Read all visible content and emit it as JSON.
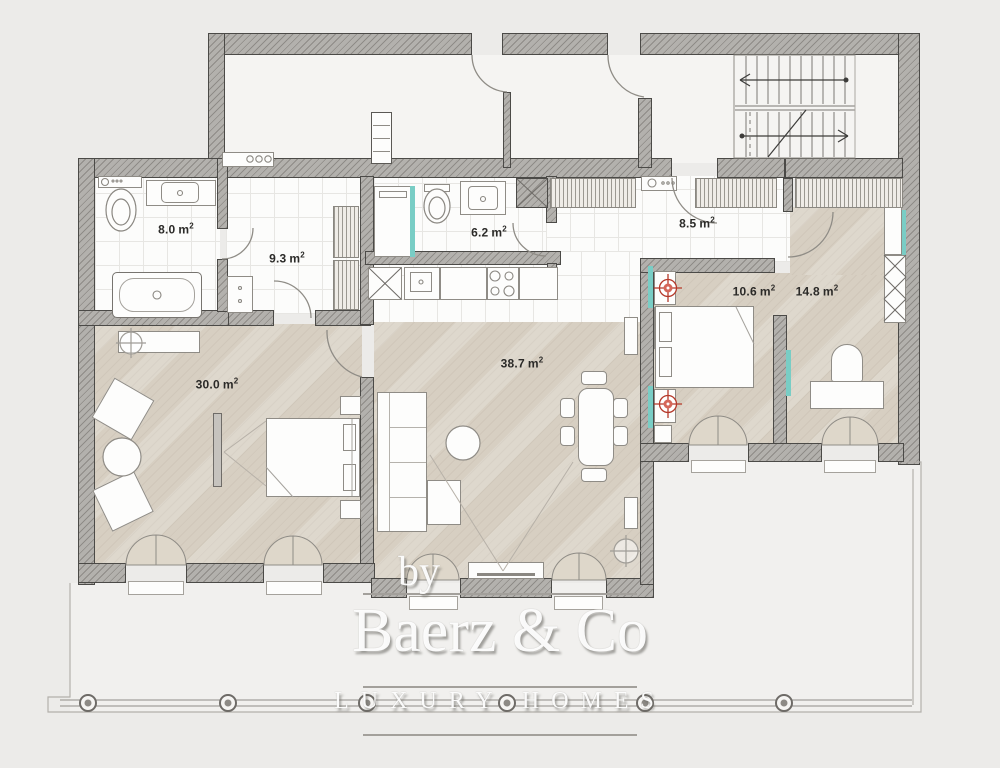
{
  "plan": {
    "type": "apartment-floor-plan",
    "rooms": [
      {
        "id": "bathroom-1",
        "area": "8.0",
        "unit": "m",
        "sup": "2"
      },
      {
        "id": "hallway",
        "area": "9.3",
        "unit": "m",
        "sup": "2"
      },
      {
        "id": "bathroom-2",
        "area": "6.2",
        "unit": "m",
        "sup": "2"
      },
      {
        "id": "entrance-hall",
        "area": "8.5",
        "unit": "m",
        "sup": "2"
      },
      {
        "id": "bedroom-1",
        "area": "30.0",
        "unit": "m",
        "sup": "2"
      },
      {
        "id": "living-room",
        "area": "38.7",
        "unit": "m",
        "sup": "2"
      },
      {
        "id": "bedroom-2",
        "area": "10.6",
        "unit": "m",
        "sup": "2"
      },
      {
        "id": "office",
        "area": "14.8",
        "unit": "m",
        "sup": "2"
      }
    ]
  },
  "watermark": {
    "prefix": "by",
    "brand": "Baerz & Co",
    "tagline": "LUXURY HOMES"
  },
  "icons": {
    "radiator-icon": "red circle crosshair",
    "ceiling-light-icon": "gray circle crosshair",
    "stairs-icon": "treads with up arrows",
    "french-door-icon": "double fan leaves",
    "wardrobe-icon": "x-crossed boxes / hatched strip"
  },
  "colors": {
    "background": "#ecebe9",
    "wall_fill": "#8e8b87",
    "wood_floor": "#d7cfc2",
    "tile_floor": "#fcfcfb",
    "glass_teal": "#79cdc5",
    "radiator_red": "#b5392a",
    "watermark_text": "#ffffff"
  }
}
